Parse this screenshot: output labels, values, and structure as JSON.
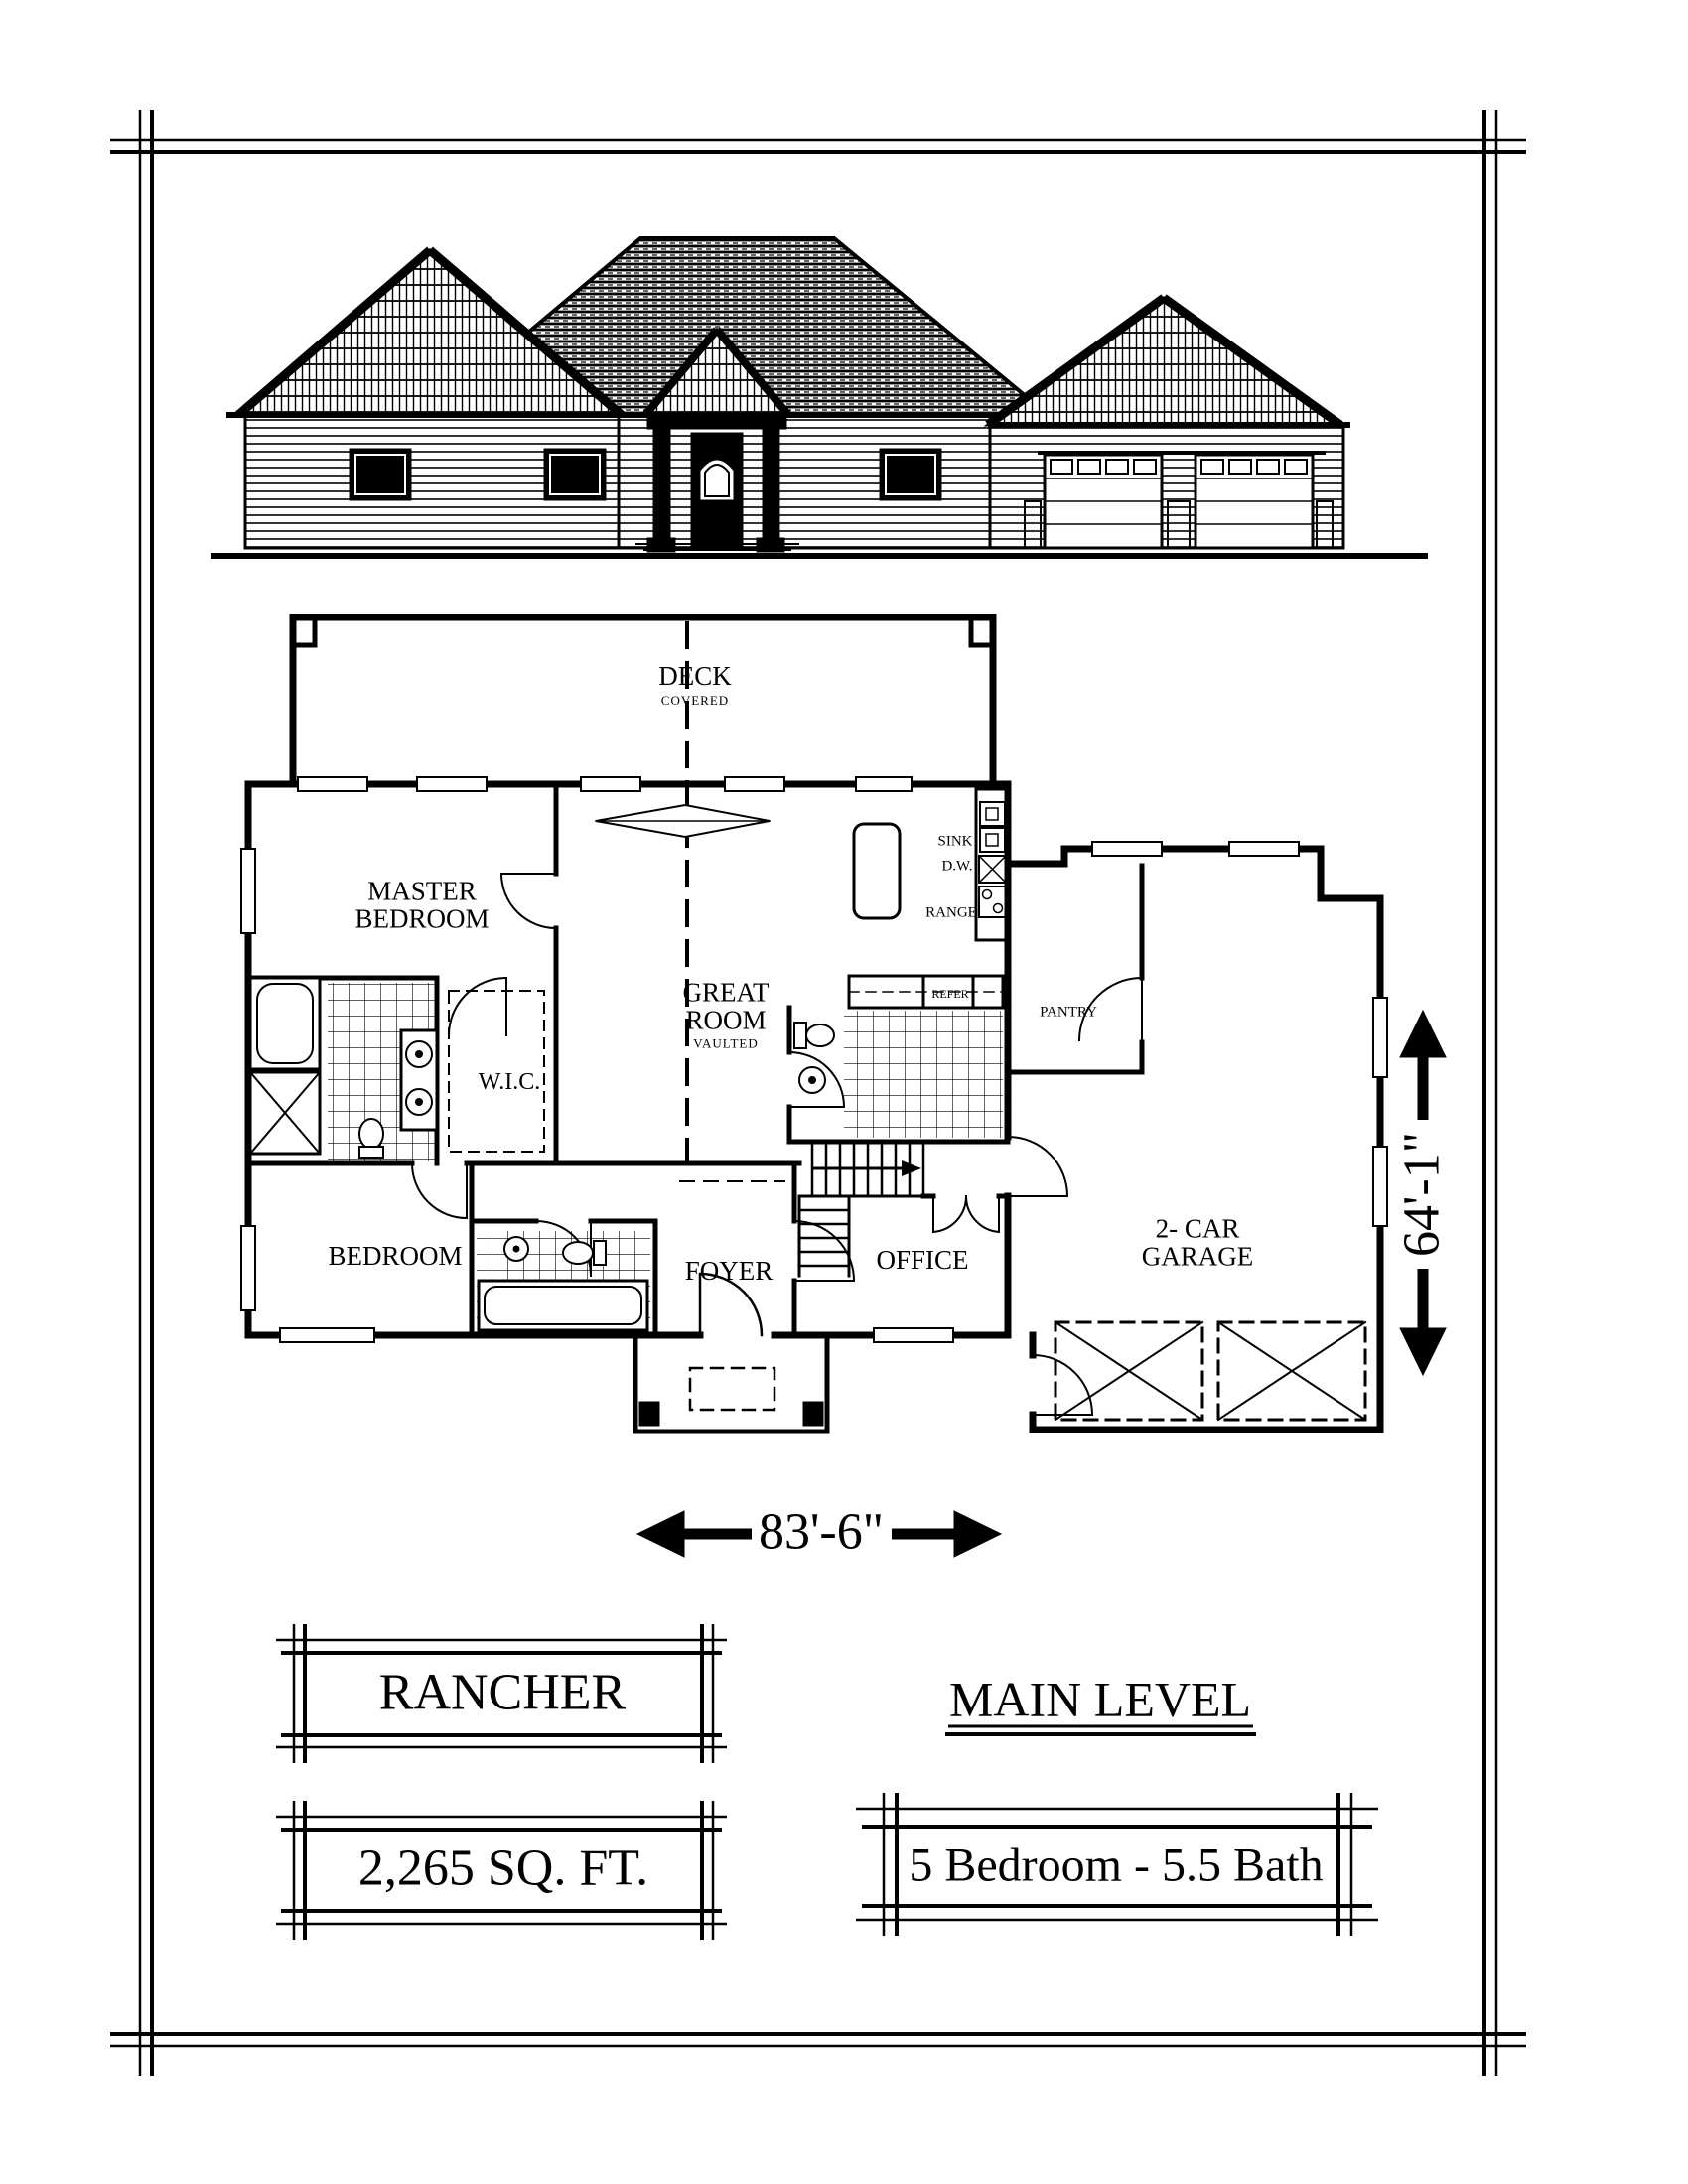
{
  "document": {
    "plan_name": "RANCHER",
    "level_label": "MAIN LEVEL",
    "area_label": "2,265 SQ. FT.",
    "config_label": "5 Bedroom - 5.5 Bath"
  },
  "dimensions": {
    "width": "83'-6\"",
    "depth": "64'-1\""
  },
  "rooms": {
    "deck": {
      "name": "DECK",
      "sub": "COVERED"
    },
    "master_bedroom": {
      "line1": "MASTER",
      "line2": "BEDROOM"
    },
    "wic": {
      "name": "W.I.C."
    },
    "bedroom": {
      "name": "BEDROOM"
    },
    "great_room": {
      "line1": "GREAT",
      "line2": "ROOM",
      "sub": "VAULTED"
    },
    "foyer": {
      "name": "FOYER"
    },
    "office": {
      "name": "OFFICE"
    },
    "pantry": {
      "name": "PANTRY"
    },
    "garage": {
      "line1": "2- CAR",
      "line2": "GARAGE"
    }
  },
  "fixtures": {
    "sink": "SINK",
    "dishwasher": "D.W.",
    "range": "RANGE",
    "refrigerator": "REFER"
  },
  "colors": {
    "ink": "#000000",
    "paper": "#ffffff"
  }
}
